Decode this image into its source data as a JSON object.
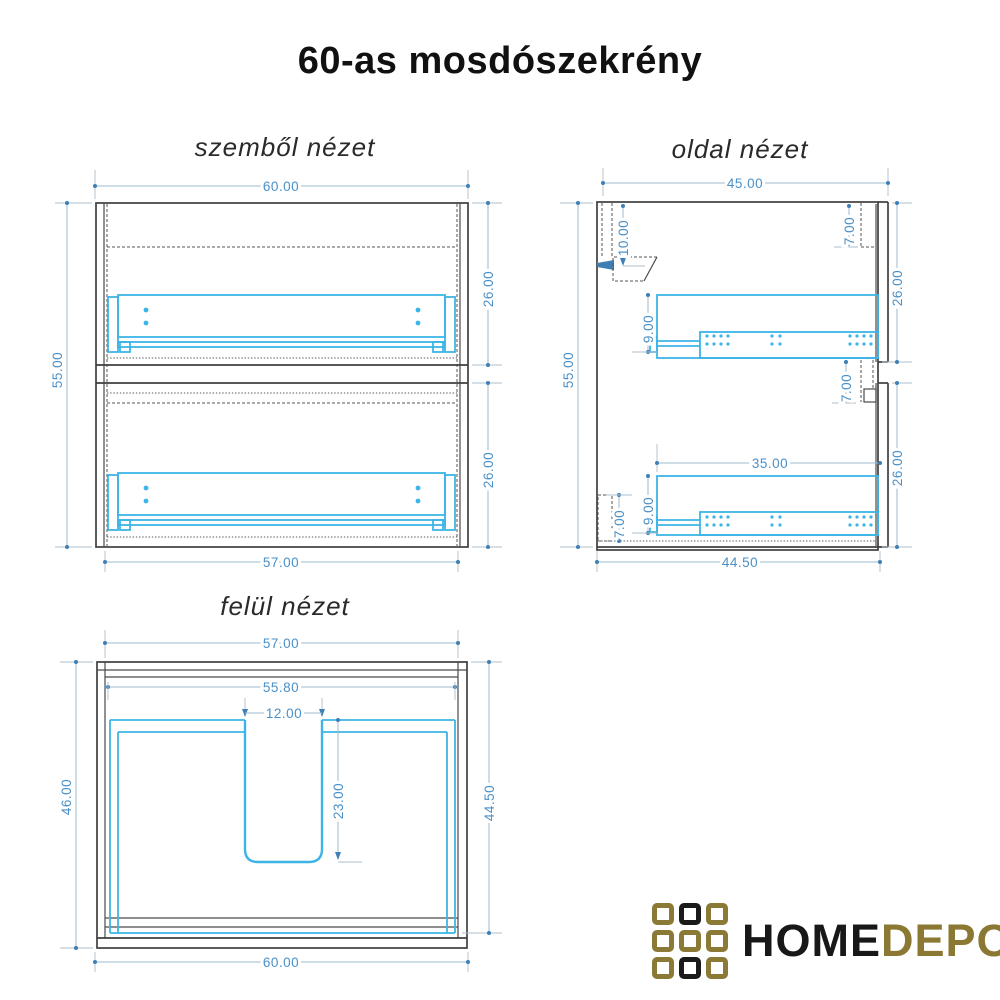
{
  "page": {
    "title": "60-as mosdószekrény"
  },
  "colors": {
    "background": "#ffffff",
    "drawing_line": "#3f3f3f",
    "hardware_cyan": "#3cb4e5",
    "dimension_text": "#4a90c8",
    "dimension_line": "#9db9cc",
    "logo_gold": "#8a7a35",
    "logo_black": "#1a1a1a"
  },
  "views": {
    "front": {
      "title": "szemből nézet",
      "dims": {
        "top_width": "60.00",
        "height": "55.00",
        "upper_drawer_height": "26.00",
        "lower_drawer_height": "26.00",
        "bottom_width": "57.00"
      }
    },
    "side": {
      "title": "oldal nézet",
      "dims": {
        "top_width": "45.00",
        "hanger_drop": "10.00",
        "top_recess": "7.00",
        "upper_section_height": "26.00",
        "upper_rail_offset": "9.00",
        "height": "55.00",
        "mid_recess": "7.00",
        "rail_length": "35.00",
        "lower_section_height": "26.00",
        "lower_rail_offset": "9.00",
        "bottom_recess": "7.00",
        "bottom_depth": "44.50"
      }
    },
    "top": {
      "title": "felül nézet",
      "dims": {
        "top_width": "57.00",
        "inner_width": "55.80",
        "cutout_width": "12.00",
        "depth_left": "46.00",
        "cutout_depth": "23.00",
        "depth_right": "44.50",
        "bottom_width": "60.00"
      }
    }
  },
  "logo": {
    "home": "HOME",
    "depo": "DEPO"
  }
}
